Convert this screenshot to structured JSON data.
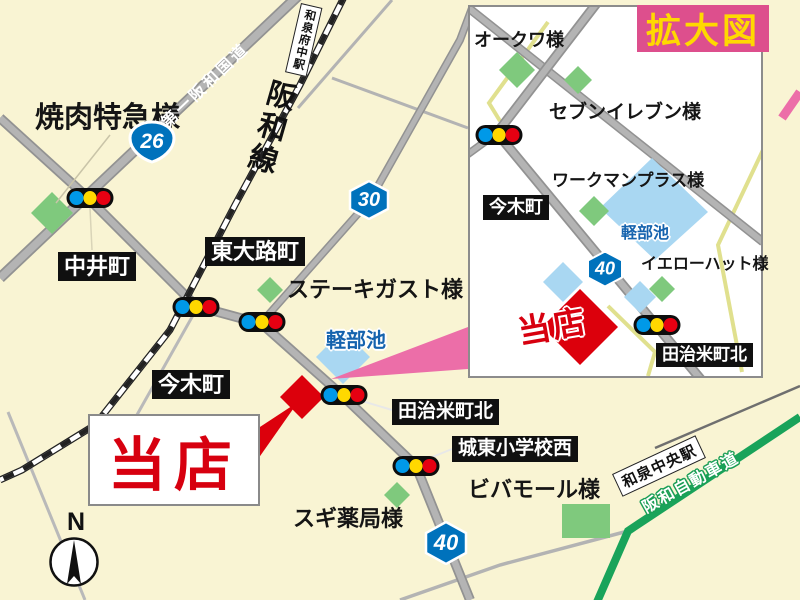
{
  "shop": {
    "label": "当店"
  },
  "compass": {
    "north": "N"
  },
  "routes": {
    "national_26": "26",
    "pref_30": "30",
    "pref_40": "40"
  },
  "main_map": {
    "pois": {
      "yakiniku": "焼肉特急様",
      "steak_gusto": "ステーキガスト様",
      "viva_mall": "ビバモール様",
      "sugi_pharmacy": "スギ薬局様"
    },
    "intersections": {
      "nakaicho": "中井町",
      "higashiojicho": "東大路町",
      "imakicho": "今木町",
      "tajimecho_kita": "田治米町北",
      "joto_shogakko_nishi": "城東小学校西"
    },
    "roads": {
      "hanwa_kokudo": "第一阪和国道",
      "hanwa_expressway": "阪和自動車道"
    },
    "railways": {
      "hanwa_line": "阪和線"
    },
    "stations": {
      "izumi_fuchu": "和泉府中駅",
      "izumi_chuo": "和泉中央駅"
    },
    "water": {
      "karube_pond": "軽部池"
    }
  },
  "inset_map": {
    "title": "拡大図",
    "pois": {
      "okuwa": "オークワ様",
      "seven_eleven": "セブンイレブン様",
      "workman_plus": "ワークマンプラス様",
      "yellow_hat": "イエローハット様"
    },
    "intersections": {
      "imakicho": "今木町",
      "tajimecho_kita": "田治米町北"
    },
    "water": {
      "karube_pond": "軽部池"
    }
  },
  "traffic_light_colors": {
    "blue": "#0099e8",
    "yellow": "#ffd800",
    "red": "#e60012"
  },
  "accent_colors": {
    "shop_red": "#d7000f",
    "badge_pink": "#dd4f8d",
    "badge_yellow": "#ffd900",
    "route_badge_blue": "#0072bc",
    "expressway_green": "#19a35a",
    "pond_blue": "#a9d7f2",
    "building_green": "#7fc97d",
    "leader_pink": "#ec6ea8"
  }
}
